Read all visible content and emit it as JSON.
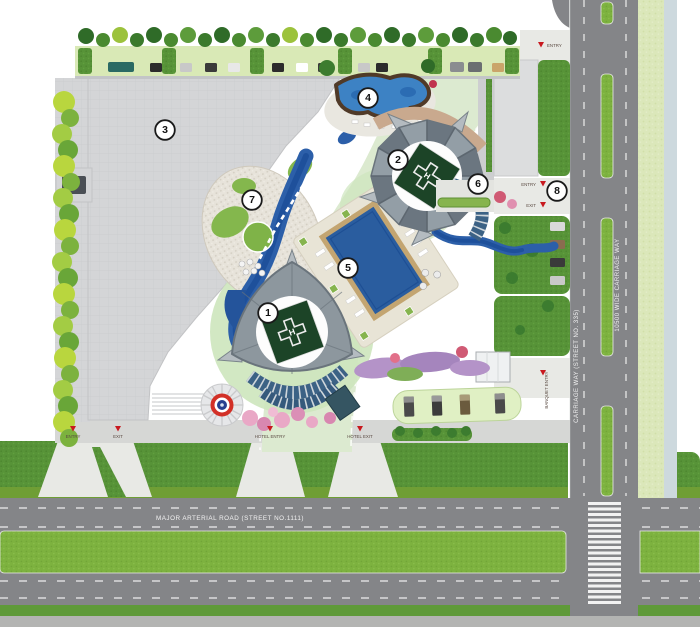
{
  "map": {
    "road_labels": {
      "major_arterial": "MAJOR ARTERIAL ROAD (STREET NO.1111)",
      "carriage_way": "CARRIAGE WAY (STREET NO. 335)",
      "wide_carriage_way": "10500 WIDE CARRIAGE WAY"
    },
    "markers": [
      "1",
      "2",
      "3",
      "4",
      "5",
      "6",
      "7",
      "8"
    ],
    "helipad_letter": "H",
    "gates": [
      {
        "label": "ENTRY"
      },
      {
        "label": "EXIT"
      },
      {
        "label": "HOTEL ENTRY"
      },
      {
        "label": "HOTEL EXIT"
      },
      {
        "label": "BANQUET ENTRY"
      },
      {
        "label": "ENTRY"
      },
      {
        "label": "ENTRY"
      },
      {
        "label": "EXIT"
      }
    ],
    "colors": {
      "grass": "#579338",
      "median_green": "#7db23f",
      "road_grey": "#848588",
      "plaza_grey": "#d4d5d7",
      "promenade_green": "#dcead0",
      "water_blue": "#2c5fa9",
      "pool_blue": "#2a5d9f",
      "helipad_green": "#1c4427",
      "gate_red": "#c8191f",
      "marker_border": "#1a1a1a"
    }
  }
}
